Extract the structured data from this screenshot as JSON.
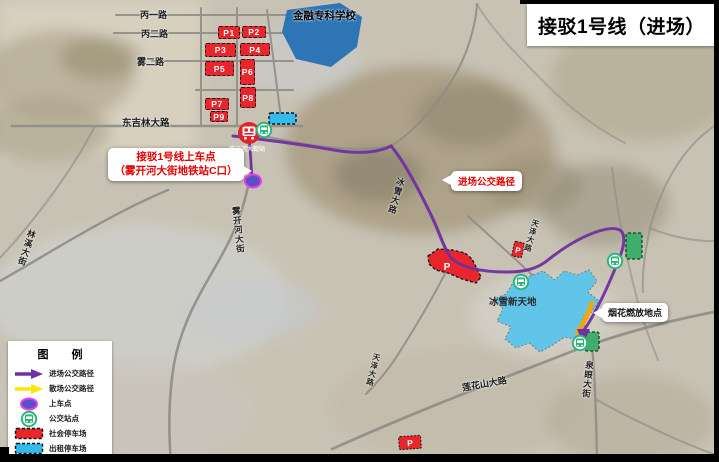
{
  "title": "接驳1号线（进场）",
  "map": {
    "school_label": "金融专科学校",
    "ice_world_label": "冰雪新天地",
    "station_label": "雾开河大街站",
    "roads": {
      "bingyi": "丙一路",
      "binger": "丙二路",
      "wuer": "雾二路",
      "dongjilin": "东吉林大路",
      "linxi": "林溪大街",
      "wukaihe": "雾开河大街",
      "bingxue": "冰雪大路",
      "tianze_east": "天泽大路",
      "tianze_west": "天泽大路",
      "lianhuashan": "莲花山大路",
      "quanyan": "泉眼大街"
    },
    "parking_lots": [
      {
        "label": "P1"
      },
      {
        "label": "P2"
      },
      {
        "label": "P3"
      },
      {
        "label": "P4"
      },
      {
        "label": "P5"
      },
      {
        "label": "P6"
      },
      {
        "label": "P7"
      },
      {
        "label": "P8"
      },
      {
        "label": "P9"
      }
    ],
    "p_markers": [
      "P",
      "P",
      "P"
    ],
    "callouts": {
      "boarding": {
        "line1": "接驳1号线上车点",
        "line2": "（雾开河大街地铁站C口）"
      },
      "route_path": "进场公交路径",
      "fireworks": "烟花燃放地点"
    }
  },
  "legend": {
    "title": "图  例",
    "items": [
      {
        "label": "进场公交路径",
        "icon": "enter-route-arrow-icon"
      },
      {
        "label": "散场公交路径",
        "icon": "exit-route-arrow-icon"
      },
      {
        "label": "上车点",
        "icon": "boarding-point-icon"
      },
      {
        "label": "公交站点",
        "icon": "bus-stop-icon"
      },
      {
        "label": "社会停车场",
        "icon": "public-parking-swatch-icon"
      },
      {
        "label": "出租停车场",
        "icon": "taxi-parking-swatch-icon"
      }
    ]
  },
  "colors": {
    "enter_route_purple": "#7030A0",
    "exit_route_yellow": "#FFE600",
    "public_parking_red": "#E8262B",
    "taxi_parking_cyan": "#33BBEE",
    "bus_stop_green": "#2EB57D",
    "boarding_dot_fill": "#5A50C4",
    "boarding_dot_ring": "#E93EE9",
    "ice_world_blue": "#5EC5EC",
    "school_blue": "#2E75B6",
    "fireworks_arrow_orange": "#F7A600"
  }
}
